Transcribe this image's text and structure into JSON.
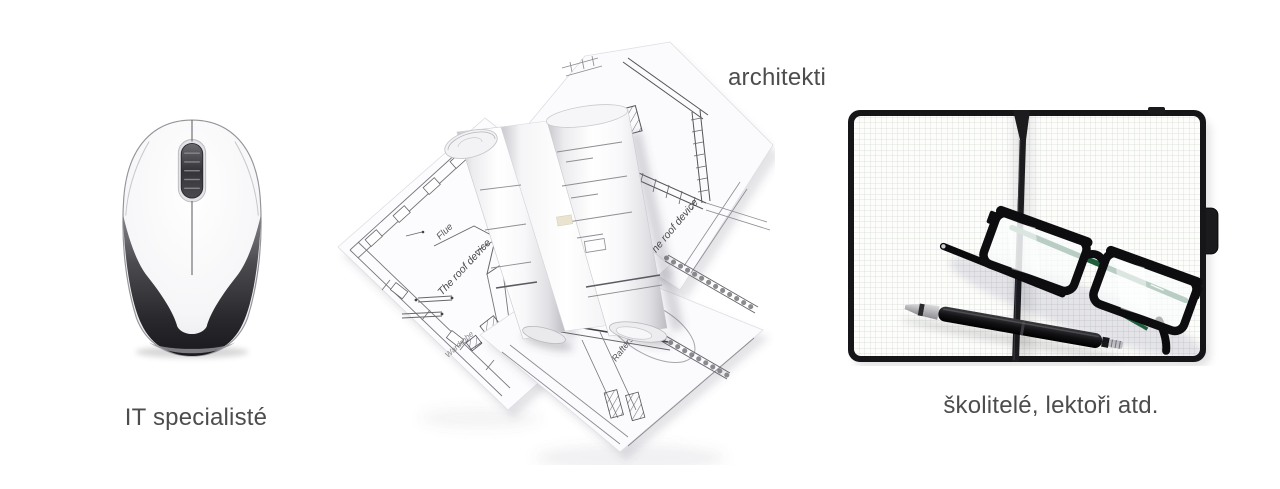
{
  "page": {
    "background_color": "#ffffff"
  },
  "audience_groups": [
    {
      "key": "it-specialists",
      "caption": "IT specialisté"
    },
    {
      "key": "architects",
      "caption": "architekti"
    },
    {
      "key": "trainers-lecturers",
      "caption": "školitelé, lektoři atd."
    }
  ],
  "blueprint_labels": {
    "flue": "Flue",
    "roof_device_left": "The roof device",
    "wardrobe": "Wardrobe",
    "roof_device_right": "The roof device",
    "rafters": "Rafters"
  },
  "colors": {
    "caption_text": "#4d4d4d",
    "glasses_green": "#1e5e3c",
    "blueprint_line": "#6d6d72",
    "mouse_dark": "#27272b"
  }
}
